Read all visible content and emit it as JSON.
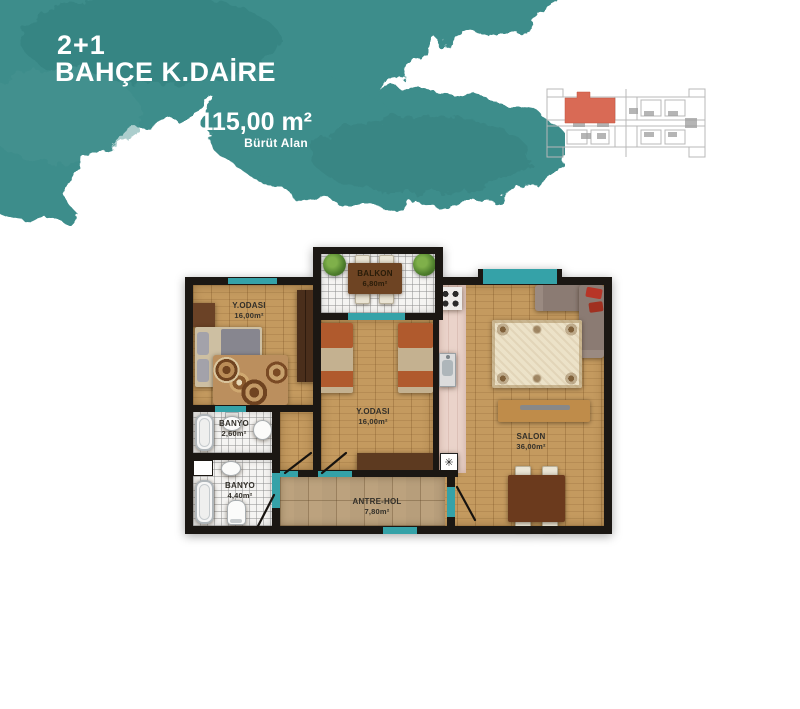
{
  "header": {
    "type_label": "2+1",
    "title": "BAHÇE K.DAİRE",
    "area_value": "115,00 m²",
    "area_caption": "Bürüt Alan"
  },
  "rooms": [
    {
      "name": "Y.ODASI",
      "area": "16,00m²"
    },
    {
      "name": "BALKON",
      "area": "6,80m²"
    },
    {
      "name": "Y.ODASI",
      "area": "16,00m²"
    },
    {
      "name": "SALON",
      "area": "36,00m²"
    },
    {
      "name": "BANYO",
      "area": "2,60m²"
    },
    {
      "name": "BANYO",
      "area": "4,40m²"
    },
    {
      "name": "ANTRE-HOL",
      "area": "7,80m²"
    }
  ],
  "icons": {
    "boiler": "✳"
  },
  "colors": {
    "brand_teal": "#3e8d8b",
    "window_teal": "#35a2a8",
    "wall": "#1b1713",
    "wood": "#c49a5f",
    "keyplan_highlight": "#d96a55"
  }
}
